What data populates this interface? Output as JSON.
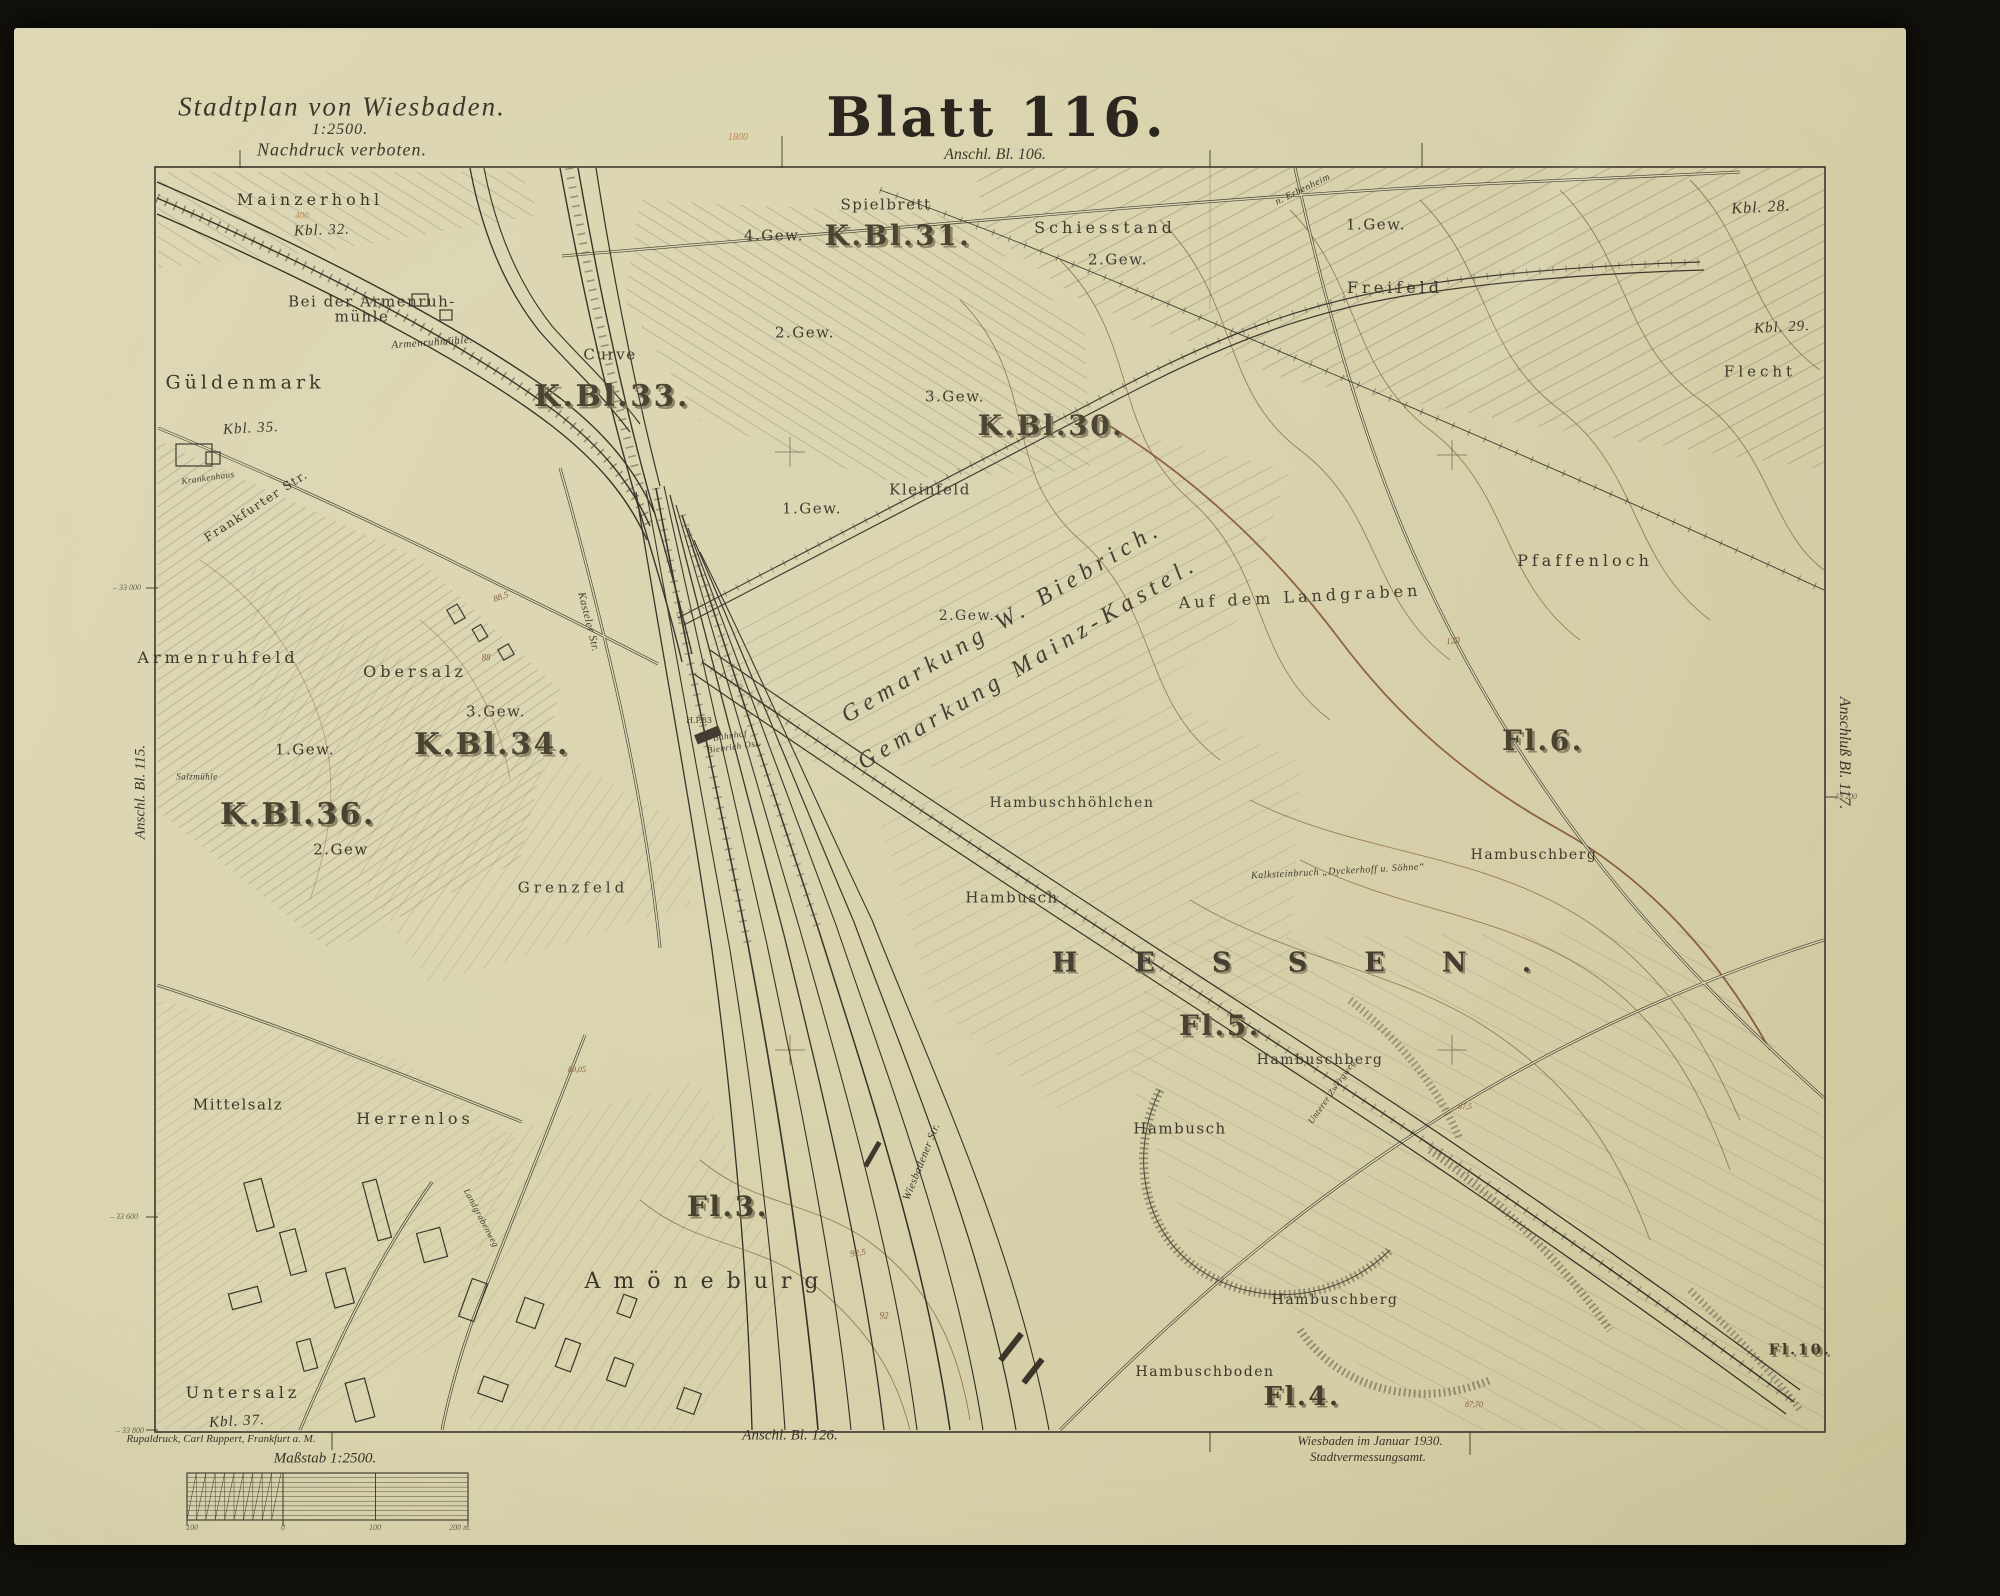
{
  "header": {
    "plan_title": "Stadtplan von Wiesbaden.",
    "plan_scale": "1:2500.",
    "plan_note": "Nachdruck verboten.",
    "sheet_title": "Blatt 116.",
    "adjoin_top": "Anschl. Bl. 106."
  },
  "edges": {
    "left": "Anschl. Bl. 115.",
    "right": "Anschluß Bl. 117.",
    "bottom": "Anschl. Bl. 126."
  },
  "footer": {
    "imprint": "Rupaldruck, Carl Ruppert, Frankfurt a. M.",
    "scale_caption": "Maßstab 1:2500.",
    "date_line1": "Wiesbaden im Januar 1930.",
    "date_line2": "Stadtvermessungsamt."
  },
  "colors": {
    "paper": "#dad4af",
    "ink": "#3a3328",
    "contour_brown": "#8a6240",
    "accent_red_brown": "#7a4a2a",
    "pencil_orange": "#b5793c",
    "photo_background": "#12100c"
  },
  "map_labels": [
    {
      "t": "Mainzerhohl",
      "x": 310,
      "y": 200,
      "r": 0,
      "s": 16,
      "c": "f2"
    },
    {
      "t": "Kbl. 32.",
      "x": 322,
      "y": 231,
      "r": -2,
      "s": 15,
      "c": "in"
    },
    {
      "t": "Bei der Armenruh-",
      "x": 372,
      "y": 302,
      "r": 0,
      "s": 15,
      "c": "f"
    },
    {
      "t": "mühle",
      "x": 362,
      "y": 317,
      "r": 0,
      "s": 15,
      "c": "f"
    },
    {
      "t": "Armenruhmühle.",
      "x": 432,
      "y": 343,
      "r": -4,
      "s": 11,
      "c": "st"
    },
    {
      "t": "Güldenmark",
      "x": 245,
      "y": 383,
      "r": 0,
      "s": 19,
      "c": "f2"
    },
    {
      "t": "Kbl. 35.",
      "x": 251,
      "y": 429,
      "r": -3,
      "s": 15,
      "c": "in"
    },
    {
      "t": "Krankenhaus",
      "x": 208,
      "y": 478,
      "r": -8,
      "s": 9,
      "c": "st"
    },
    {
      "t": "Frankfurter Str.",
      "x": 256,
      "y": 506,
      "r": -33,
      "s": 12,
      "c": "f"
    },
    {
      "t": "Curve",
      "x": 610,
      "y": 355,
      "r": 0,
      "s": 15,
      "c": "f"
    },
    {
      "t": "K.Bl.33.",
      "x": 612,
      "y": 397,
      "r": 0,
      "s": 30,
      "c": "k"
    },
    {
      "t": "4.Gew.",
      "x": 774,
      "y": 236,
      "r": 0,
      "s": 15,
      "c": "f"
    },
    {
      "t": "Spielbrett",
      "x": 886,
      "y": 205,
      "r": 0,
      "s": 15,
      "c": "f"
    },
    {
      "t": "K.Bl.31.",
      "x": 898,
      "y": 236,
      "r": 0,
      "s": 28,
      "c": "k"
    },
    {
      "t": "Schiesstand",
      "x": 1105,
      "y": 228,
      "r": 0,
      "s": 16,
      "c": "f2"
    },
    {
      "t": "n. Erbenheim",
      "x": 1303,
      "y": 190,
      "r": -26,
      "s": 10,
      "c": "st"
    },
    {
      "t": "1.Gew.",
      "x": 1376,
      "y": 225,
      "r": 0,
      "s": 15,
      "c": "f"
    },
    {
      "t": "Freifeld",
      "x": 1395,
      "y": 288,
      "r": 0,
      "s": 16,
      "c": "f2"
    },
    {
      "t": "2.Gew.",
      "x": 1118,
      "y": 260,
      "r": 0,
      "s": 15,
      "c": "f"
    },
    {
      "t": "Kbl. 28.",
      "x": 1761,
      "y": 208,
      "r": -3,
      "s": 16,
      "c": "in"
    },
    {
      "t": "Kbl. 29.",
      "x": 1782,
      "y": 328,
      "r": -3,
      "s": 15,
      "c": "in"
    },
    {
      "t": "Flecht",
      "x": 1760,
      "y": 372,
      "r": 0,
      "s": 15,
      "c": "f2"
    },
    {
      "t": "2.Gew.",
      "x": 805,
      "y": 333,
      "r": 0,
      "s": 15,
      "c": "f"
    },
    {
      "t": "3.Gew.",
      "x": 955,
      "y": 397,
      "r": 0,
      "s": 15,
      "c": "f"
    },
    {
      "t": "K.Bl.30.",
      "x": 1051,
      "y": 426,
      "r": 0,
      "s": 28,
      "c": "k"
    },
    {
      "t": "Kleinfeld",
      "x": 930,
      "y": 490,
      "r": 0,
      "s": 15,
      "c": "f"
    },
    {
      "t": "1.Gew.",
      "x": 812,
      "y": 509,
      "r": 0,
      "s": 15,
      "c": "f"
    },
    {
      "t": "2.Gew.",
      "x": 967,
      "y": 616,
      "r": 0,
      "s": 14,
      "c": "f"
    },
    {
      "t": "Gemarkung W. Biebrich.",
      "x": 1002,
      "y": 622,
      "r": -31,
      "s": 24,
      "c": "g"
    },
    {
      "t": "Gemarkung Mainz-Kastel.",
      "x": 1028,
      "y": 663,
      "r": -31,
      "s": 24,
      "c": "g"
    },
    {
      "t": "Auf dem Landgraben",
      "x": 1300,
      "y": 597,
      "r": -3,
      "s": 16,
      "c": "f2"
    },
    {
      "t": "Pfaffenloch",
      "x": 1585,
      "y": 561,
      "r": 0,
      "s": 16,
      "c": "f2"
    },
    {
      "t": "Hambuschhöhlchen",
      "x": 1072,
      "y": 803,
      "r": 0,
      "s": 14,
      "c": "f"
    },
    {
      "t": "Hambusch",
      "x": 1012,
      "y": 898,
      "r": 0,
      "s": 15,
      "c": "f"
    },
    {
      "t": "Fl.6.",
      "x": 1543,
      "y": 741,
      "r": 0,
      "s": 28,
      "c": "k"
    },
    {
      "t": "Hambuschberg",
      "x": 1534,
      "y": 855,
      "r": 0,
      "s": 14,
      "c": "f"
    },
    {
      "t": "HESSEN.",
      "x": 1320,
      "y": 963,
      "r": 0,
      "s": 27,
      "c": "h"
    },
    {
      "t": "Fl.5.",
      "x": 1220,
      "y": 1026,
      "r": 0,
      "s": 28,
      "c": "k"
    },
    {
      "t": "Hambuschberg",
      "x": 1320,
      "y": 1060,
      "r": 0,
      "s": 14,
      "c": "f"
    },
    {
      "t": "Hambusch",
      "x": 1180,
      "y": 1129,
      "r": 0,
      "s": 15,
      "c": "f"
    },
    {
      "t": "Unterer Zwergweg",
      "x": 1332,
      "y": 1092,
      "r": -55,
      "s": 9,
      "c": "st"
    },
    {
      "t": "Kalksteinbruch „Dyckerhoff u. Söhne“",
      "x": 1338,
      "y": 872,
      "r": -3,
      "s": 10,
      "c": "st"
    },
    {
      "t": "Mittelsalz",
      "x": 238,
      "y": 1105,
      "r": 0,
      "s": 15,
      "c": "f"
    },
    {
      "t": "Herrenlos",
      "x": 415,
      "y": 1119,
      "r": 0,
      "s": 16,
      "c": "f2"
    },
    {
      "t": "Landgrabenweg",
      "x": 481,
      "y": 1218,
      "r": 62,
      "s": 9,
      "c": "st"
    },
    {
      "t": "Fl.3.",
      "x": 728,
      "y": 1207,
      "r": 0,
      "s": 28,
      "c": "k"
    },
    {
      "t": "Amöneburg",
      "x": 708,
      "y": 1282,
      "r": 0,
      "s": 22,
      "c": "a"
    },
    {
      "t": "Wiesbadener Str.",
      "x": 922,
      "y": 1162,
      "r": -68,
      "s": 11,
      "c": "st"
    },
    {
      "t": "Untersalz",
      "x": 243,
      "y": 1393,
      "r": 0,
      "s": 16,
      "c": "f2"
    },
    {
      "t": "Kbl. 37.",
      "x": 237,
      "y": 1422,
      "r": -3,
      "s": 15,
      "c": "in"
    },
    {
      "t": "Hambuschberg",
      "x": 1335,
      "y": 1300,
      "r": 0,
      "s": 14,
      "c": "f"
    },
    {
      "t": "Hambuschboden",
      "x": 1205,
      "y": 1372,
      "r": 0,
      "s": 14,
      "c": "f"
    },
    {
      "t": "Fl.4.",
      "x": 1302,
      "y": 1397,
      "r": 0,
      "s": 26,
      "c": "k"
    },
    {
      "t": "Fl.10.",
      "x": 1800,
      "y": 1350,
      "r": 0,
      "s": 15,
      "c": "k"
    },
    {
      "t": "Bahnhof",
      "x": 730,
      "y": 736,
      "r": -8,
      "s": 9,
      "c": "st"
    },
    {
      "t": "Biebrich Ost.",
      "x": 734,
      "y": 747,
      "r": -8,
      "s": 9,
      "c": "st"
    },
    {
      "t": "H.P.83",
      "x": 699,
      "y": 721,
      "r": 0,
      "s": 8,
      "c": "tiny"
    },
    {
      "t": "Salzmühle",
      "x": 197,
      "y": 777,
      "r": 0,
      "s": 9,
      "c": "st"
    },
    {
      "t": "Kasteler Str.",
      "x": 588,
      "y": 622,
      "r": 76,
      "s": 11,
      "c": "st"
    },
    {
      "t": "3.Gew.",
      "x": 496,
      "y": 712,
      "r": 0,
      "s": 15,
      "c": "f"
    },
    {
      "t": "K.Bl.34.",
      "x": 492,
      "y": 745,
      "r": 0,
      "s": 30,
      "c": "k"
    },
    {
      "t": "1.Gew.",
      "x": 305,
      "y": 750,
      "r": 0,
      "s": 15,
      "c": "f"
    },
    {
      "t": "K.Bl.36.",
      "x": 298,
      "y": 815,
      "r": 0,
      "s": 30,
      "c": "k"
    },
    {
      "t": "2.Gew",
      "x": 341,
      "y": 850,
      "r": 0,
      "s": 15,
      "c": "f"
    },
    {
      "t": "Grenzfeld",
      "x": 573,
      "y": 888,
      "r": 0,
      "s": 15,
      "c": "f2"
    },
    {
      "t": "Armenruhfeld",
      "x": 218,
      "y": 658,
      "r": 0,
      "s": 16,
      "c": "f2"
    },
    {
      "t": "Obersalz",
      "x": 415,
      "y": 672,
      "r": 0,
      "s": 16,
      "c": "f2"
    },
    {
      "t": "– 33 000",
      "x": 127,
      "y": 588,
      "r": 0,
      "s": 8,
      "c": "tk"
    },
    {
      "t": "– 33 600",
      "x": 124,
      "y": 1217,
      "r": 0,
      "s": 8,
      "c": "tk"
    },
    {
      "t": "– 33 800",
      "x": 130,
      "y": 1431,
      "r": 0,
      "s": 8,
      "c": "tk"
    },
    {
      "t": "– 33 200",
      "x": 1843,
      "y": 797,
      "r": 0,
      "s": 8,
      "c": "tk"
    },
    {
      "t": "88,5",
      "x": 501,
      "y": 597,
      "r": -20,
      "s": 9,
      "c": "br"
    },
    {
      "t": "88",
      "x": 486,
      "y": 658,
      "r": 0,
      "s": 9,
      "c": "br"
    },
    {
      "t": "92,5",
      "x": 858,
      "y": 1253,
      "r": -8,
      "s": 9,
      "c": "br"
    },
    {
      "t": "92",
      "x": 884,
      "y": 1316,
      "r": 0,
      "s": 9,
      "c": "br"
    },
    {
      "t": "87,5",
      "x": 1465,
      "y": 1107,
      "r": 0,
      "s": 8,
      "c": "br"
    },
    {
      "t": "120",
      "x": 1453,
      "y": 641,
      "r": -5,
      "s": 9,
      "c": "br"
    },
    {
      "t": "89,05",
      "x": 577,
      "y": 1070,
      "r": 0,
      "s": 8,
      "c": "br"
    },
    {
      "t": "87,70",
      "x": 1474,
      "y": 1405,
      "r": 0,
      "s": 8,
      "c": "br"
    },
    {
      "t": "1800",
      "x": 738,
      "y": 138,
      "r": 0,
      "s": 10,
      "c": "pc"
    },
    {
      "t": "400",
      "x": 302,
      "y": 216,
      "r": 0,
      "s": 9,
      "c": "pc"
    },
    {
      "t": "100",
      "x": 192,
      "y": 1528,
      "r": 0,
      "s": 8,
      "c": "tk"
    },
    {
      "t": "0",
      "x": 283,
      "y": 1528,
      "r": 0,
      "s": 8,
      "c": "tk"
    },
    {
      "t": "100",
      "x": 375,
      "y": 1528,
      "r": 0,
      "s": 8,
      "c": "tk"
    },
    {
      "t": "200 m.",
      "x": 460,
      "y": 1528,
      "r": 0,
      "s": 8,
      "c": "tk"
    }
  ]
}
